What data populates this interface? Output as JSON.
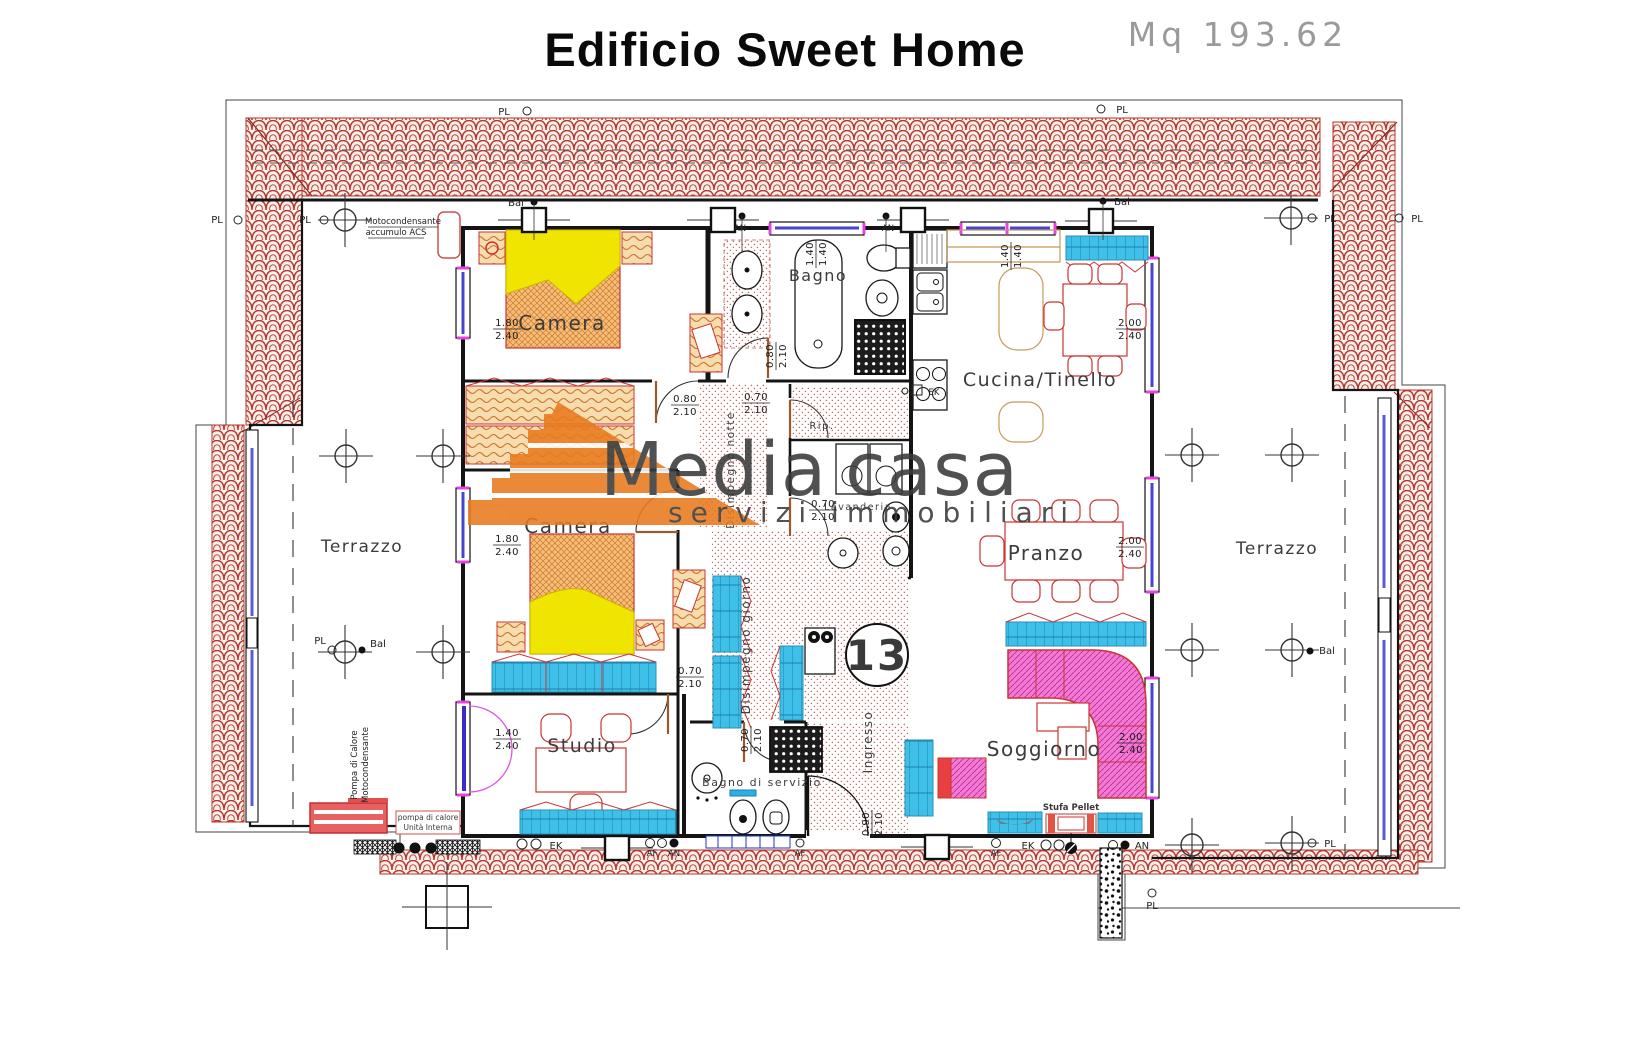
{
  "header": {
    "title": "Edificio Sweet Home",
    "area": "Mq 193.62"
  },
  "watermark": {
    "brand_gray": "Media",
    "brand_orange": "casa",
    "tagline": "servizi immobiliari"
  },
  "badge": {
    "number": "13"
  },
  "rooms": {
    "camera": "Camera",
    "bagno": "Bagno",
    "cucina": "Cucina/Tinello",
    "terrazzo": "Terrazzo",
    "pranzo": "Pranzo",
    "soggiorno": "Soggiorno",
    "studio": "Studio",
    "bagno_servizio": "Bagno di servizio",
    "disimpegno_notte": "Disimpegno notte",
    "disimpegno_giorno": "Disimpegno giorno",
    "ingresso": "Ingresso",
    "lavanderia": "Lavanderia",
    "rip": "Rip."
  },
  "equipment": {
    "moto_line1": "Motocondensante",
    "moto_line2": "accumulo ACS",
    "pompa_line1": "Pompa di Calore",
    "pompa_line2": "Motocondensante",
    "unita_line1": "pompa di calore",
    "unita_line2": "Unità Interna",
    "stufa": "Stufa Pellet"
  },
  "markers": {
    "pl": "PL",
    "bal": "Bal",
    "an": "AN",
    "af": "AF",
    "ek": "EK"
  },
  "dims": {
    "d180_240": {
      "w": "1.80",
      "h": "2.40"
    },
    "d140_240": {
      "w": "1.40",
      "h": "2.40"
    },
    "d140_140": {
      "w": "1.40",
      "h": "1.40"
    },
    "d200_240": {
      "w": "2.00",
      "h": "2.40"
    },
    "d080_210": {
      "w": "0.80",
      "h": "2.10"
    },
    "d070_210": {
      "w": "0.70",
      "h": "2.10"
    },
    "d090_210": {
      "w": "0.90",
      "h": "2.10"
    }
  },
  "colors": {
    "roof_red": "#b5352c",
    "cad_red": "#cc3333",
    "cyan": "#3fc0e8",
    "yellow": "#f0e500",
    "logo_orange": "#e87b1e",
    "pink": "#f07ad6",
    "window_blue": "#4545d0",
    "frame_magenta": "#e643e0"
  }
}
